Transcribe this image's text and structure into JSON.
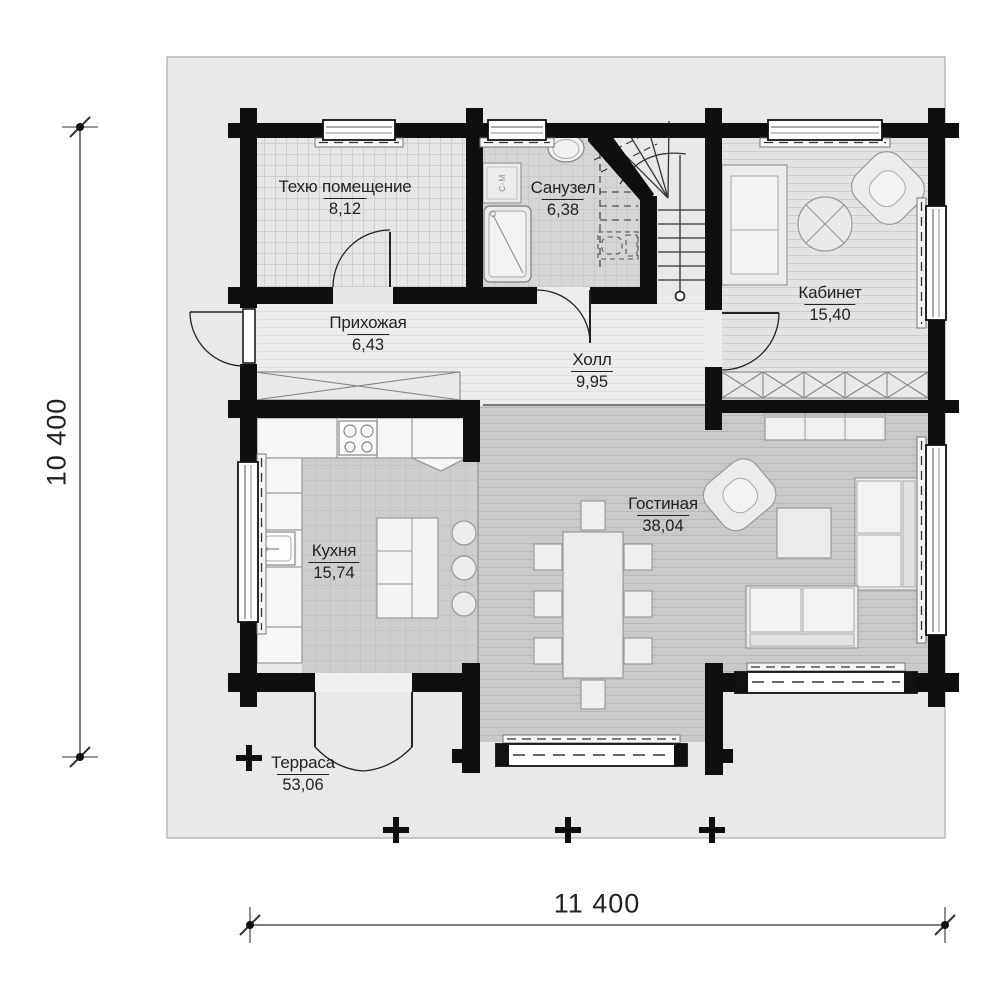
{
  "plan": {
    "rooms": [
      {
        "id": "tech",
        "name": "Техю помещение",
        "area": "8,12"
      },
      {
        "id": "bathroom",
        "name": "Санузел",
        "area": "6,38"
      },
      {
        "id": "study",
        "name": "Кабинет",
        "area": "15,40"
      },
      {
        "id": "entry",
        "name": "Прихожая",
        "area": "6,43"
      },
      {
        "id": "hall",
        "name": "Холл",
        "area": "9,95"
      },
      {
        "id": "kitchen",
        "name": "Кухня",
        "area": "15,74"
      },
      {
        "id": "living",
        "name": "Гостиная",
        "area": "38,04"
      },
      {
        "id": "terrace",
        "name": "Терраса",
        "area": "53,06"
      }
    ],
    "dimensions": {
      "horizontal": "11 400",
      "vertical": "10 400"
    },
    "appliance_labels": {
      "washing_machine": "С-М"
    },
    "colors": {
      "wall": "#0f0f0f",
      "terrace_bg": "#e9e9e9",
      "tech_floor": "#e6e6e6",
      "bath_floor": "#d6d6d6",
      "kitchen_floor": "#cecece",
      "living_floor": "#c9c9c9",
      "plank_light": "#ebebeb",
      "line": "#333333"
    }
  }
}
